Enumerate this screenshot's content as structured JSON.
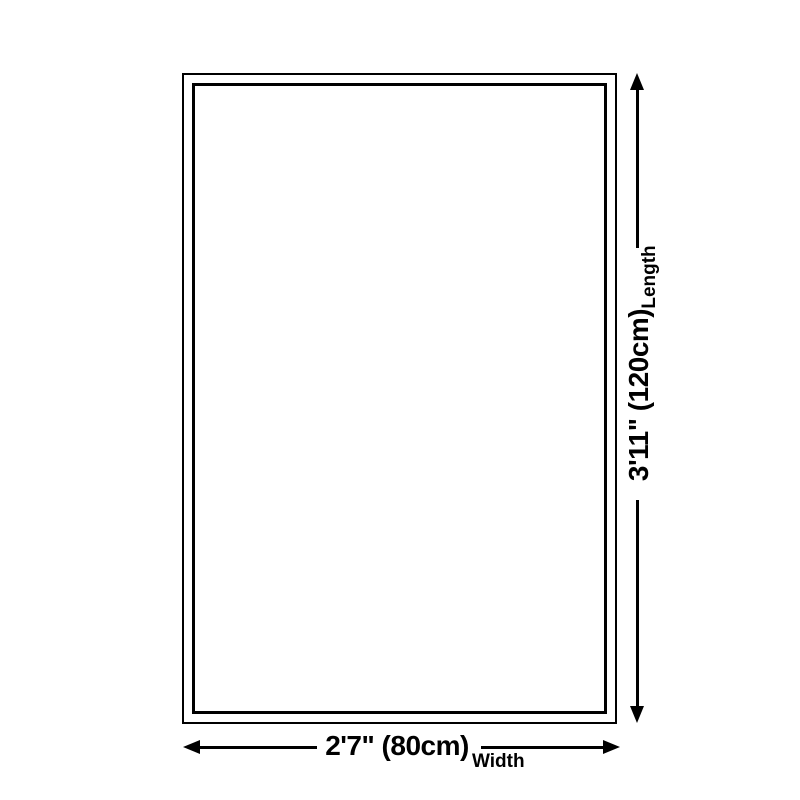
{
  "diagram": {
    "type": "product-size-diagram",
    "shape": "rectangle-rug-outline",
    "dimensions": {
      "length": {
        "value": "3'11\" (120cm)",
        "label": "Length",
        "orientation": "vertical"
      },
      "width": {
        "value": "2'7\" (80cm)",
        "label": "Width",
        "orientation": "horizontal"
      }
    },
    "colors": {
      "line": "#000000",
      "background": "#ffffff"
    }
  }
}
